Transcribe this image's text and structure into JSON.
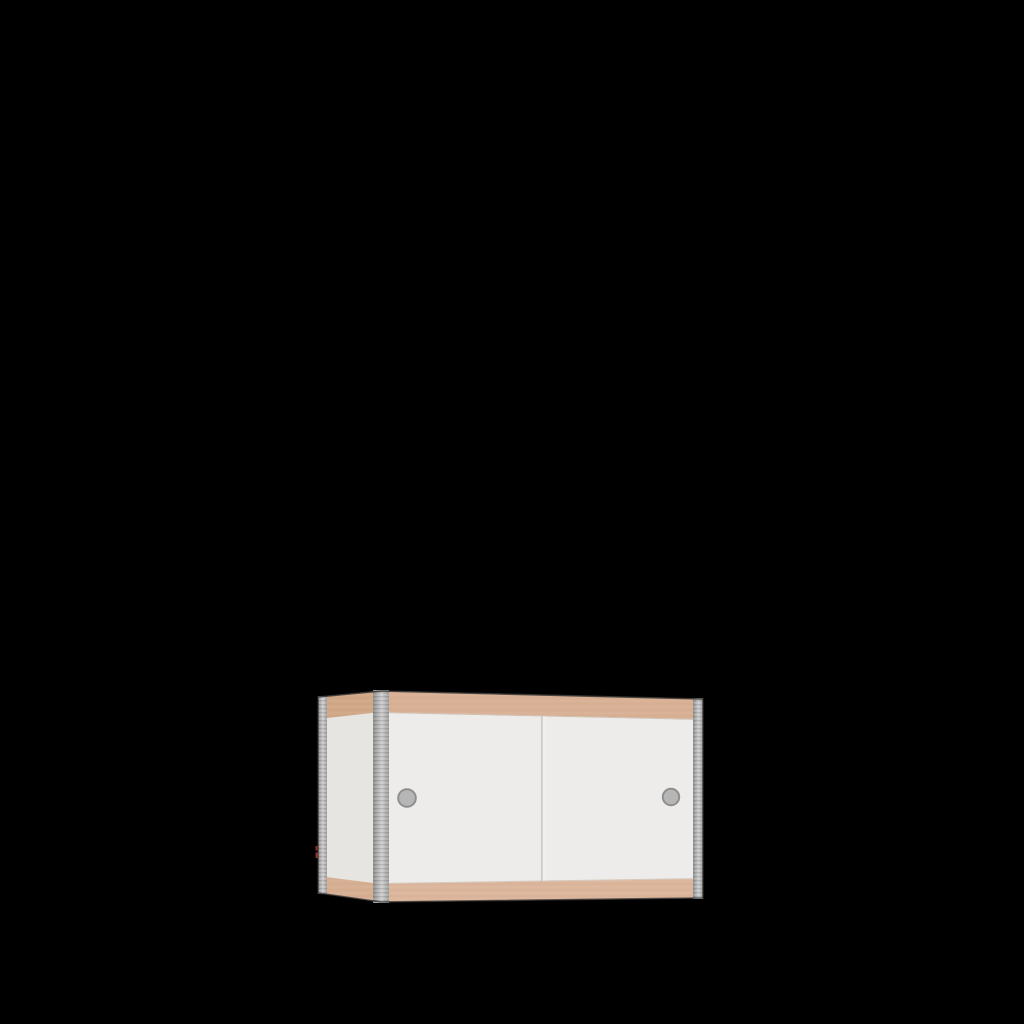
{
  "scene": {
    "description": "3D product render of a small wall cabinet with two white sliding doors, plywood edge strips and aluminum corner rails, centered low on a black background",
    "object": "sliding-door-cabinet"
  },
  "colors": {
    "background": "#000000",
    "side_white": "#e7e5e2",
    "door_white": "#edecea",
    "wood_front_top": "#d8b095",
    "wood_front_bottom": "#dcb69c",
    "wood_side_top": "#d0a888",
    "wood_side_bottom": "#d6af93",
    "rail_edge": "#8c8c8c",
    "rail_mid": "#b3b3b3",
    "rail_light": "#cfcfcf",
    "rail_end": "#9e9e9e",
    "hole_center": "#b6b6b6",
    "hole_edge": "#a8a8a8",
    "hole_rim": "#8f8f8f",
    "divider": "#c7c6c3",
    "divider_highlight": "#f3f2ef",
    "wood_seam": "#c2ab97",
    "top_edge_line": "#6f5f53",
    "outline": "#2e2e2e",
    "artifact_red": "#b03a2e"
  },
  "geometry": {
    "outline": "318,697 381,691 703,699 703,898 381,902 318,893",
    "side_face": "318,697 381,691 381,902 318,893",
    "front_face": "381,691 703,699 703,898 381,902",
    "side_wood_top": "318,697 381,691 381,712 318,719",
    "side_wood_bottom": "318,876 381,884 381,902 318,893",
    "front_wood_top": "381,691 703,699 703,719 381,712",
    "front_wood_bottom": "381,884 703,879 703,898 381,902",
    "rail_back_left": "318,696 327,696 327,894 318,894",
    "rail_front_left": "373,690 389,690 389,903 373,903",
    "rail_right": "693,698 703,698 703,899 693,899",
    "divider": "541,716 542.8,716 542.8,881 541,881",
    "divider_highlight": "542.8,716 545.5,716 545.5,881 542.8,881",
    "top_edge_line": "318,697 381,691 703,699",
    "wood_seam_top": "381,712.5 703,719.5",
    "wood_seam_bottom": "381,883.5 703,878.5",
    "artifact_a": "315.5,846 317.5,846 317.5,850.5 315.5,850.5",
    "artifact_b": "315.5,852.5 318,852.5 318,858 315.5,858"
  },
  "holes": {
    "left": {
      "cx": 407,
      "cy": 798,
      "r": 8.8
    },
    "right": {
      "cx": 671,
      "cy": 797,
      "r": 8.2
    }
  }
}
